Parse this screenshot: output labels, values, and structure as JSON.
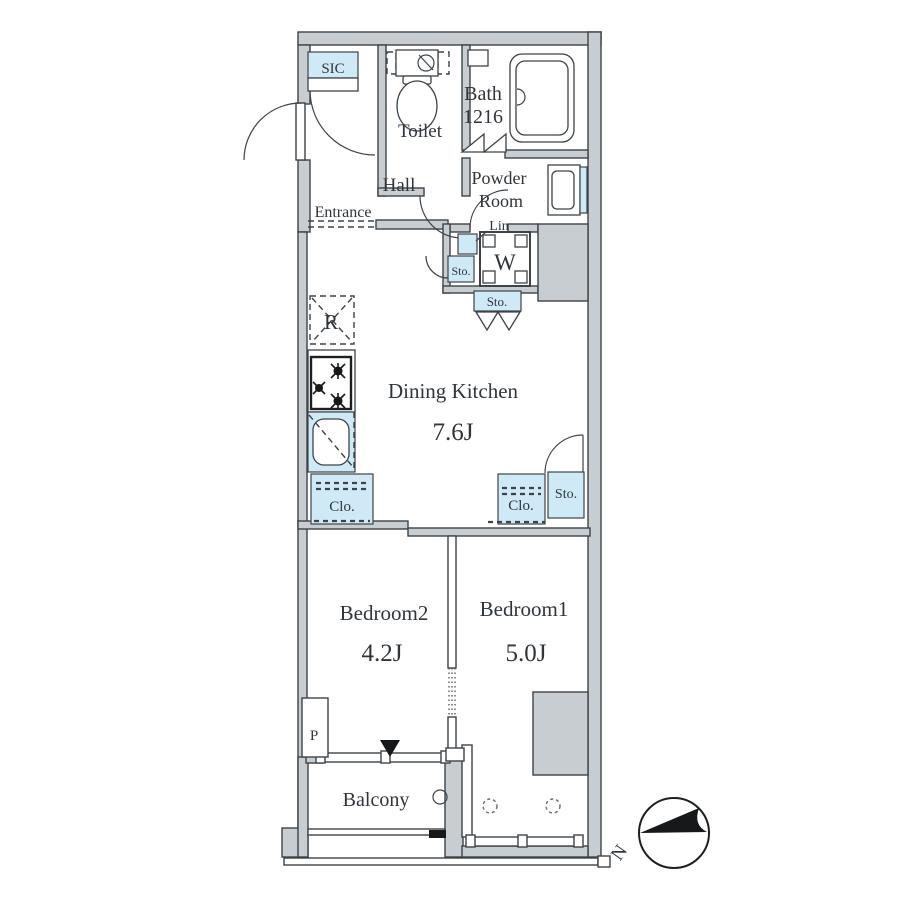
{
  "plan": {
    "labels": {
      "sic": "SIC",
      "entrance": "Entrance",
      "toilet": "Toilet",
      "bath_line1": "Bath",
      "bath_line2": "1216",
      "hall": "Hall",
      "powder_line1": "Powder",
      "powder_line2": "Room",
      "lin": "Lin",
      "washer": "W",
      "sto": "Sto.",
      "refrigerator": "R",
      "dining_kitchen": "Dining Kitchen",
      "dining_kitchen_size": "7.6J",
      "clo": "Clo.",
      "bedroom2": "Bedroom2",
      "bedroom2_size": "4.2J",
      "bedroom1": "Bedroom1",
      "bedroom1_size": "5.0J",
      "pipe_space": "P",
      "balcony": "Balcony",
      "compass_north": "N"
    },
    "colors": {
      "wall": "#c8cdd2",
      "line": "#3d4347",
      "blue": "#cfe9f7",
      "text": "#30353a",
      "ink": "#16181a"
    }
  }
}
